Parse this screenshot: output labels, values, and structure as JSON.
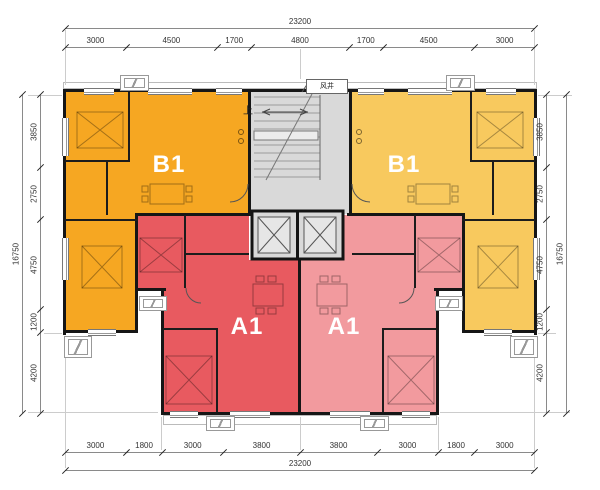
{
  "units": [
    {
      "id": "b1-left",
      "label": "B1",
      "color": "#F6A722"
    },
    {
      "id": "b1-right",
      "label": "B1",
      "color": "#F8C95E"
    },
    {
      "id": "a1-left",
      "label": "A1",
      "color": "#E85A60"
    },
    {
      "id": "a1-right",
      "label": "A1",
      "color": "#F29A9E"
    }
  ],
  "core": {
    "up_label": "上",
    "shaft_label": "风井",
    "fill": "#D9D9D9"
  },
  "palette": {
    "wall": "#161616",
    "dimension_text": "#333333",
    "background": "#FFFFFF"
  },
  "dimensions": {
    "top": {
      "total": "23200",
      "segments": [
        "3000",
        "4500",
        "1700",
        "4800",
        "1700",
        "4500",
        "3000"
      ]
    },
    "bottom": {
      "total": "23200",
      "segments": [
        "3000",
        "1800",
        "3000",
        "3800",
        "3800",
        "3000",
        "1800",
        "3000"
      ]
    },
    "left": {
      "total": "16750",
      "segments": [
        "3850",
        "2750",
        "4750",
        "1200",
        "4200"
      ]
    },
    "right": {
      "total": "16750",
      "segments": [
        "3850",
        "2750",
        "4750",
        "1200",
        "4200"
      ]
    }
  }
}
